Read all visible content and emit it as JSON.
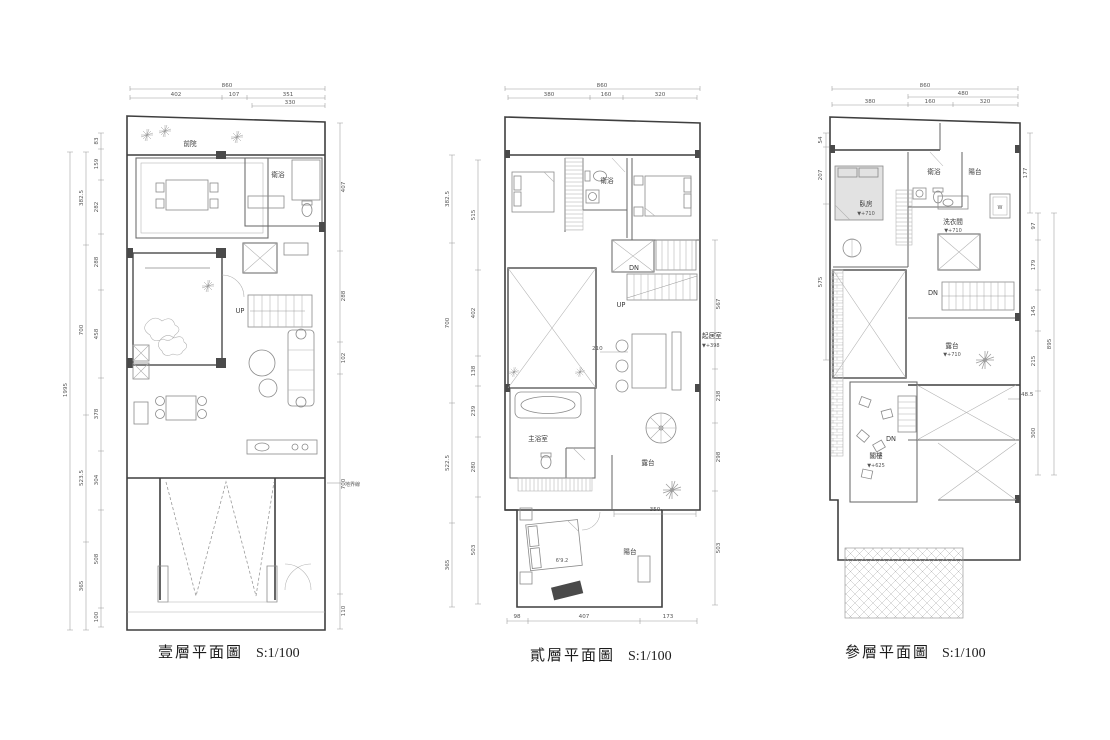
{
  "sheet": {
    "background": "#ffffff",
    "wall_color": "#3f3f3f",
    "line_color": "#8a8a8a",
    "dim_color": "#9a9a9a"
  },
  "plans": [
    {
      "id": "first-floor",
      "title": "壹層平面圖",
      "scale": "S:1/100",
      "rooms": {
        "front_yard": "前院",
        "bathroom": "衛浴",
        "up": "UP",
        "property_line": "地界線"
      },
      "dims": {
        "top_total": "860",
        "top_1": "402",
        "top_2": "107",
        "top_3": "351",
        "top_sub": "330",
        "left_total": "1995",
        "left_outer": [
          "382.5",
          "700",
          "523.5",
          "365"
        ],
        "left_inner": [
          "83",
          "159",
          "282",
          "288",
          "458",
          "378",
          "304",
          "508",
          "100"
        ],
        "right": [
          "407",
          "288",
          "102",
          "700",
          "110"
        ]
      }
    },
    {
      "id": "second-floor",
      "title": "貳層平面圖",
      "scale": "S:1/100",
      "rooms": {
        "bathroom": "衛浴",
        "dn": "DN",
        "up": "UP",
        "living": "起居室",
        "living_elev": "▼+398",
        "master_bath": "主浴室",
        "terrace": "露台",
        "balcony": "陽台",
        "bed_size": "6'9.2"
      },
      "dims": {
        "top_total": "860",
        "top_1": "380",
        "top_2": "160",
        "top_3": "320",
        "left_outer": [
          "382.5",
          "700",
          "522.5",
          "365"
        ],
        "left_inner": [
          "515",
          "402",
          "138",
          "239",
          "280",
          "503"
        ],
        "right": [
          "567",
          "238",
          "298",
          "503"
        ],
        "mid_210": "210",
        "mid_350": "350",
        "bottom_1": "98",
        "bottom_2": "407",
        "bottom_3": "173"
      }
    },
    {
      "id": "third-floor",
      "title": "參層平面圖",
      "scale": "S:1/100",
      "rooms": {
        "bedroom": "臥房",
        "bedroom_elev": "▼+710",
        "bathroom": "衛浴",
        "balcony": "陽台",
        "laundry": "洗衣間",
        "laundry_elev": "▼+710",
        "washer": "W",
        "dn_upper": "DN",
        "dn_attic": "DN",
        "terrace": "露台",
        "terrace_elev": "▼+710",
        "attic": "閣樓",
        "attic_elev": "▼+625"
      },
      "dims": {
        "top_total": "860",
        "top_sub": "480",
        "top_1": "380",
        "top_2": "160",
        "top_3": "320",
        "left_1": "54",
        "left_2": "207",
        "left_3": "575",
        "right_top": "177",
        "right_chain": [
          "97",
          "179",
          "145",
          "215",
          "300"
        ],
        "right_total": "895",
        "offset": "48.5"
      }
    }
  ]
}
